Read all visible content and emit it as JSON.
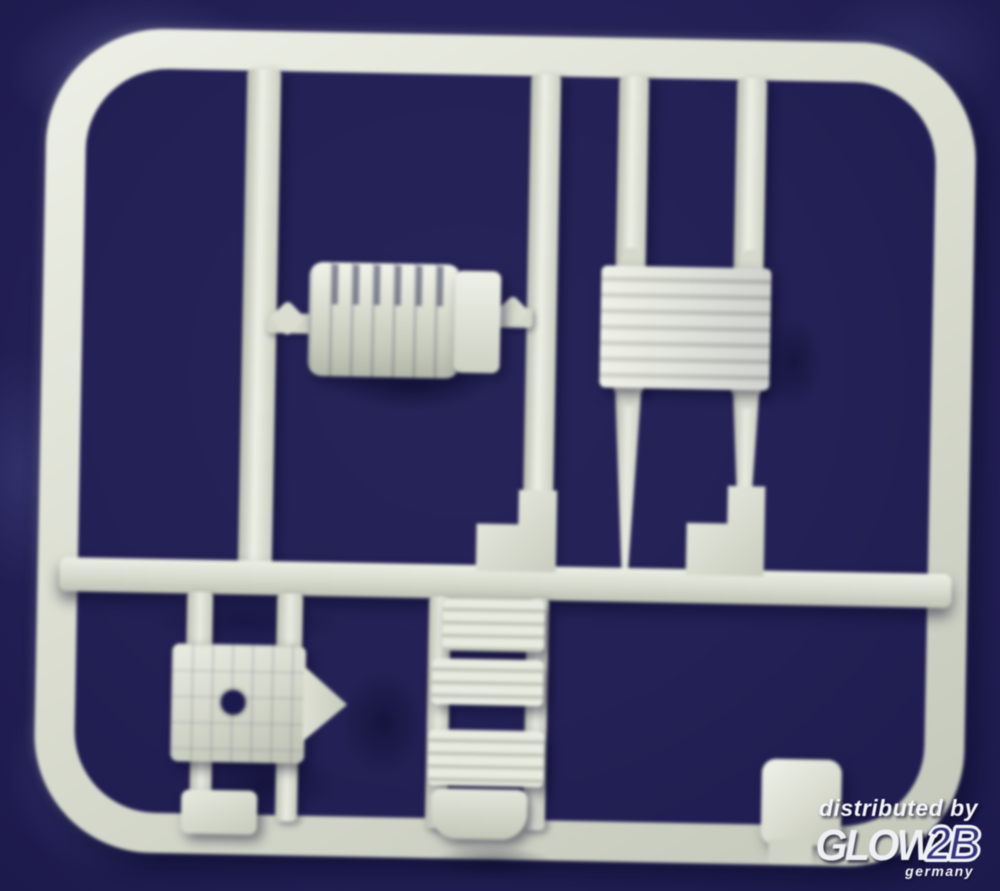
{
  "watermark": {
    "line1": "distributed by",
    "brand_left": "GLOW",
    "brand_right": "2B",
    "country": "germany"
  },
  "colors": {
    "background_navy": "#242158",
    "sprue_plastic": "#dde0d3",
    "watermark_text": "#f4f5f8",
    "brand_2b_fill": "#353380",
    "shadow_navy": "#0a0a28"
  }
}
